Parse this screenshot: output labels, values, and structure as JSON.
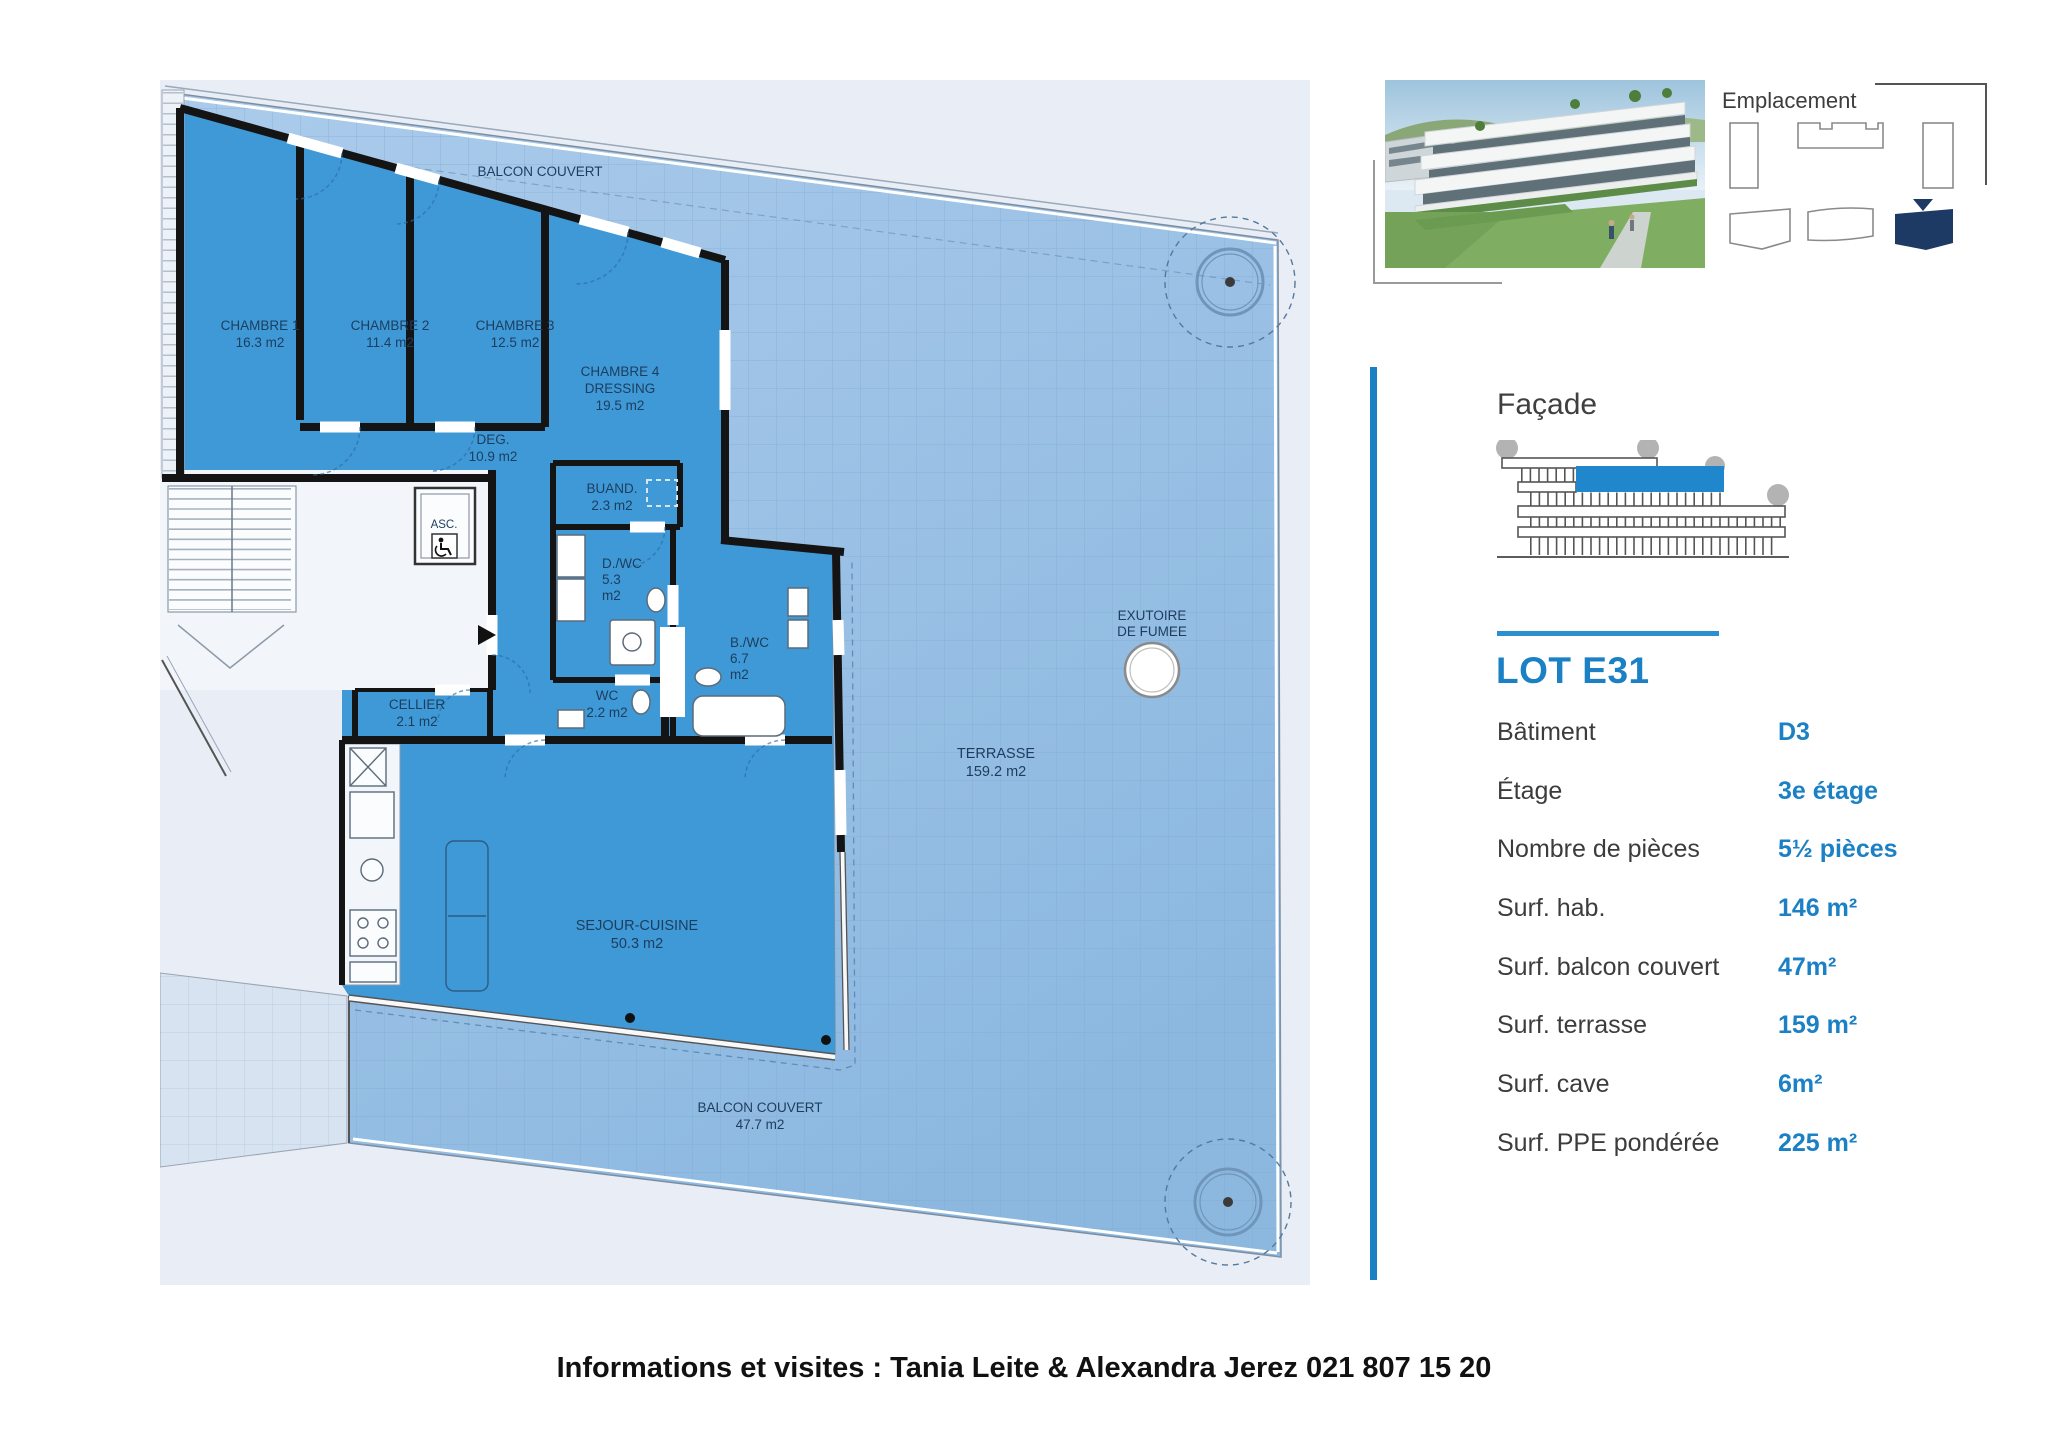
{
  "plan": {
    "balcony_top": "BALCON COUVERT",
    "rooms": [
      {
        "name": "CHAMBRE 1",
        "area": "16.3 m2"
      },
      {
        "name": "CHAMBRE 2",
        "area": "11.4 m2"
      },
      {
        "name": "CHAMBRE 3",
        "area": "12.5 m2"
      },
      {
        "name": "CHAMBRE 4",
        "name2": "DRESSING",
        "area": "19.5 m2"
      },
      {
        "name": "DEG.",
        "area": "10.9 m2"
      },
      {
        "name": "BUAND.",
        "area": "2.3 m2"
      },
      {
        "name": "ASC."
      },
      {
        "name": "D./WC",
        "line2": "5.3",
        "line3": "m2"
      },
      {
        "name": "B./WC",
        "line2": "6.7",
        "line3": "m2"
      },
      {
        "name": "WC",
        "area": "2.2 m2"
      },
      {
        "name": "CELLIER",
        "area": "2.1 m2"
      },
      {
        "name": "SEJOUR-CUISINE",
        "area": "50.3 m2"
      },
      {
        "name": "TERRASSE",
        "area": "159.2 m2"
      },
      {
        "name": "EXUTOIRE",
        "name2": "DE FUMEE"
      },
      {
        "name": "BALCON COUVERT",
        "area": "47.7 m2"
      }
    ]
  },
  "emplacement": {
    "title": "Emplacement"
  },
  "facade": {
    "title": "Façade"
  },
  "lot": {
    "title": "LOT E31",
    "rows": [
      {
        "label": "Bâtiment",
        "value": "D3"
      },
      {
        "label": "Étage",
        "value": "3e étage"
      },
      {
        "label": "Nombre de pièces",
        "value": "5½ pièces"
      },
      {
        "label": "Surf. hab.",
        "value": "146 m²"
      },
      {
        "label": "Surf. balcon couvert",
        "value": "47m²"
      },
      {
        "label": "Surf. terrasse",
        "value": "159 m²"
      },
      {
        "label": "Surf. cave",
        "value": "6m²"
      },
      {
        "label": "Surf. PPE pondérée",
        "value": "225 m²"
      }
    ]
  },
  "footer": {
    "contact": "Informations et visites : Tania Leite & Alexandra Jerez 021 807 15 20"
  },
  "icons": {
    "elevator": "wheelchair-icon",
    "location_marker": "triangle-marker-icon",
    "trees_plan": "tree-plan-icon",
    "smoke_vent": "circle-vent-icon"
  },
  "colors": {
    "accent_blue": "#1B80C4",
    "room_blue": "#3F99D6",
    "terrace_blue": "#9CC2E6",
    "facade_highlight": "#2187CC",
    "navy": "#1C3A63",
    "wall": "#141414",
    "label_navy": "#1C3D5E"
  }
}
